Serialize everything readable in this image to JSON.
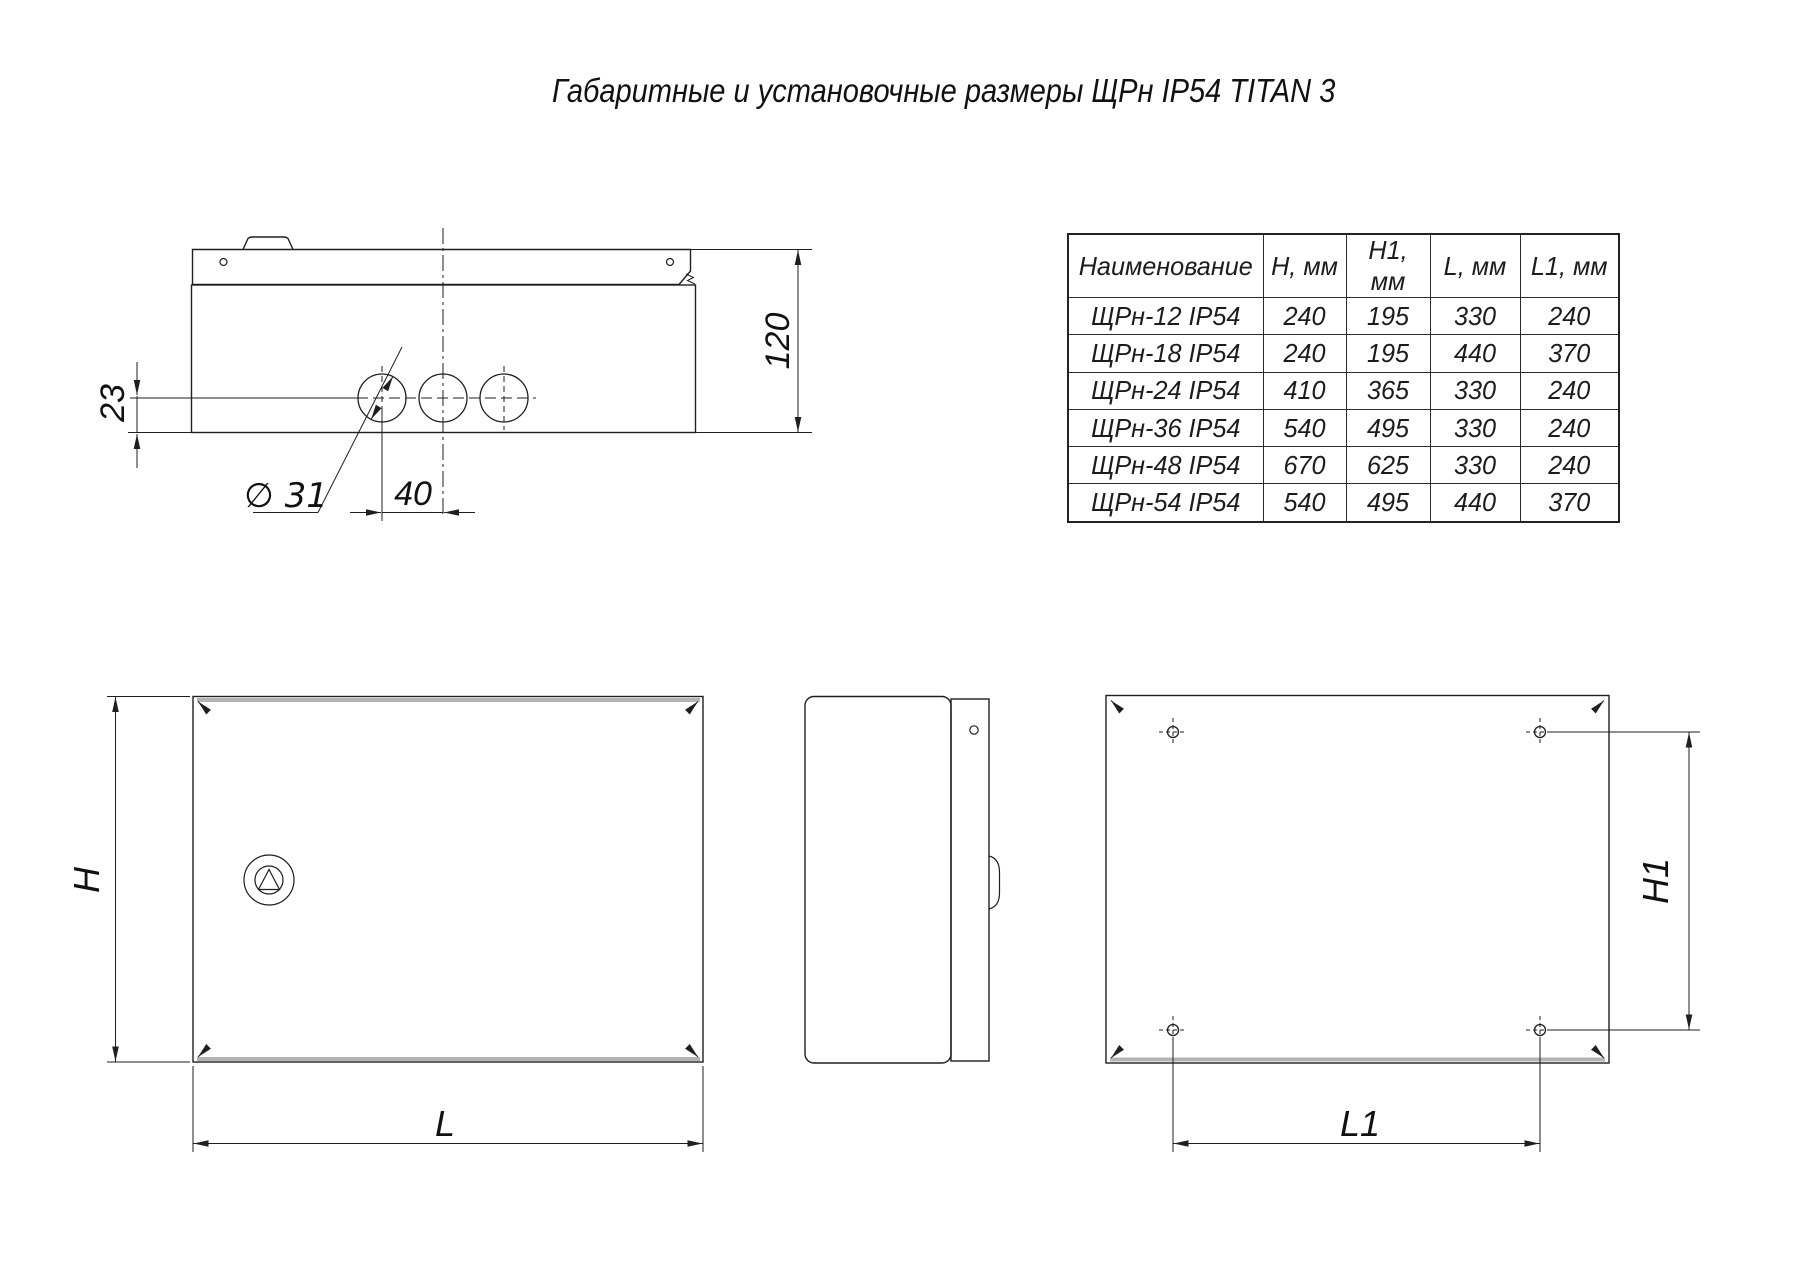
{
  "title": "Габаритные и установочные размеры ЩРн IP54 TITAN 3",
  "table": {
    "headers": [
      "Наименование",
      "H, мм",
      "H1, мм",
      "L, мм",
      "L1, мм"
    ],
    "rows": [
      [
        "ЩРн-12 IP54",
        "240",
        "195",
        "330",
        "240"
      ],
      [
        "ЩРн-18 IP54",
        "240",
        "195",
        "440",
        "370"
      ],
      [
        "ЩРн-24 IP54",
        "410",
        "365",
        "330",
        "240"
      ],
      [
        "ЩРн-36 IP54",
        "540",
        "495",
        "330",
        "240"
      ],
      [
        "ЩРн-48 IP54",
        "670",
        "625",
        "330",
        "240"
      ],
      [
        "ЩРн-54 IP54",
        "540",
        "495",
        "440",
        "370"
      ]
    ]
  },
  "dims": {
    "depth": "120",
    "gland_offset": "23",
    "gland_diameter": "∅ 31",
    "gland_spacing": "40",
    "height": "H",
    "length": "L",
    "mount_height": "H1",
    "mount_length": "L1"
  },
  "colors": {
    "line": "#1f1f1f",
    "thick_edge": "#b3b3b3"
  }
}
